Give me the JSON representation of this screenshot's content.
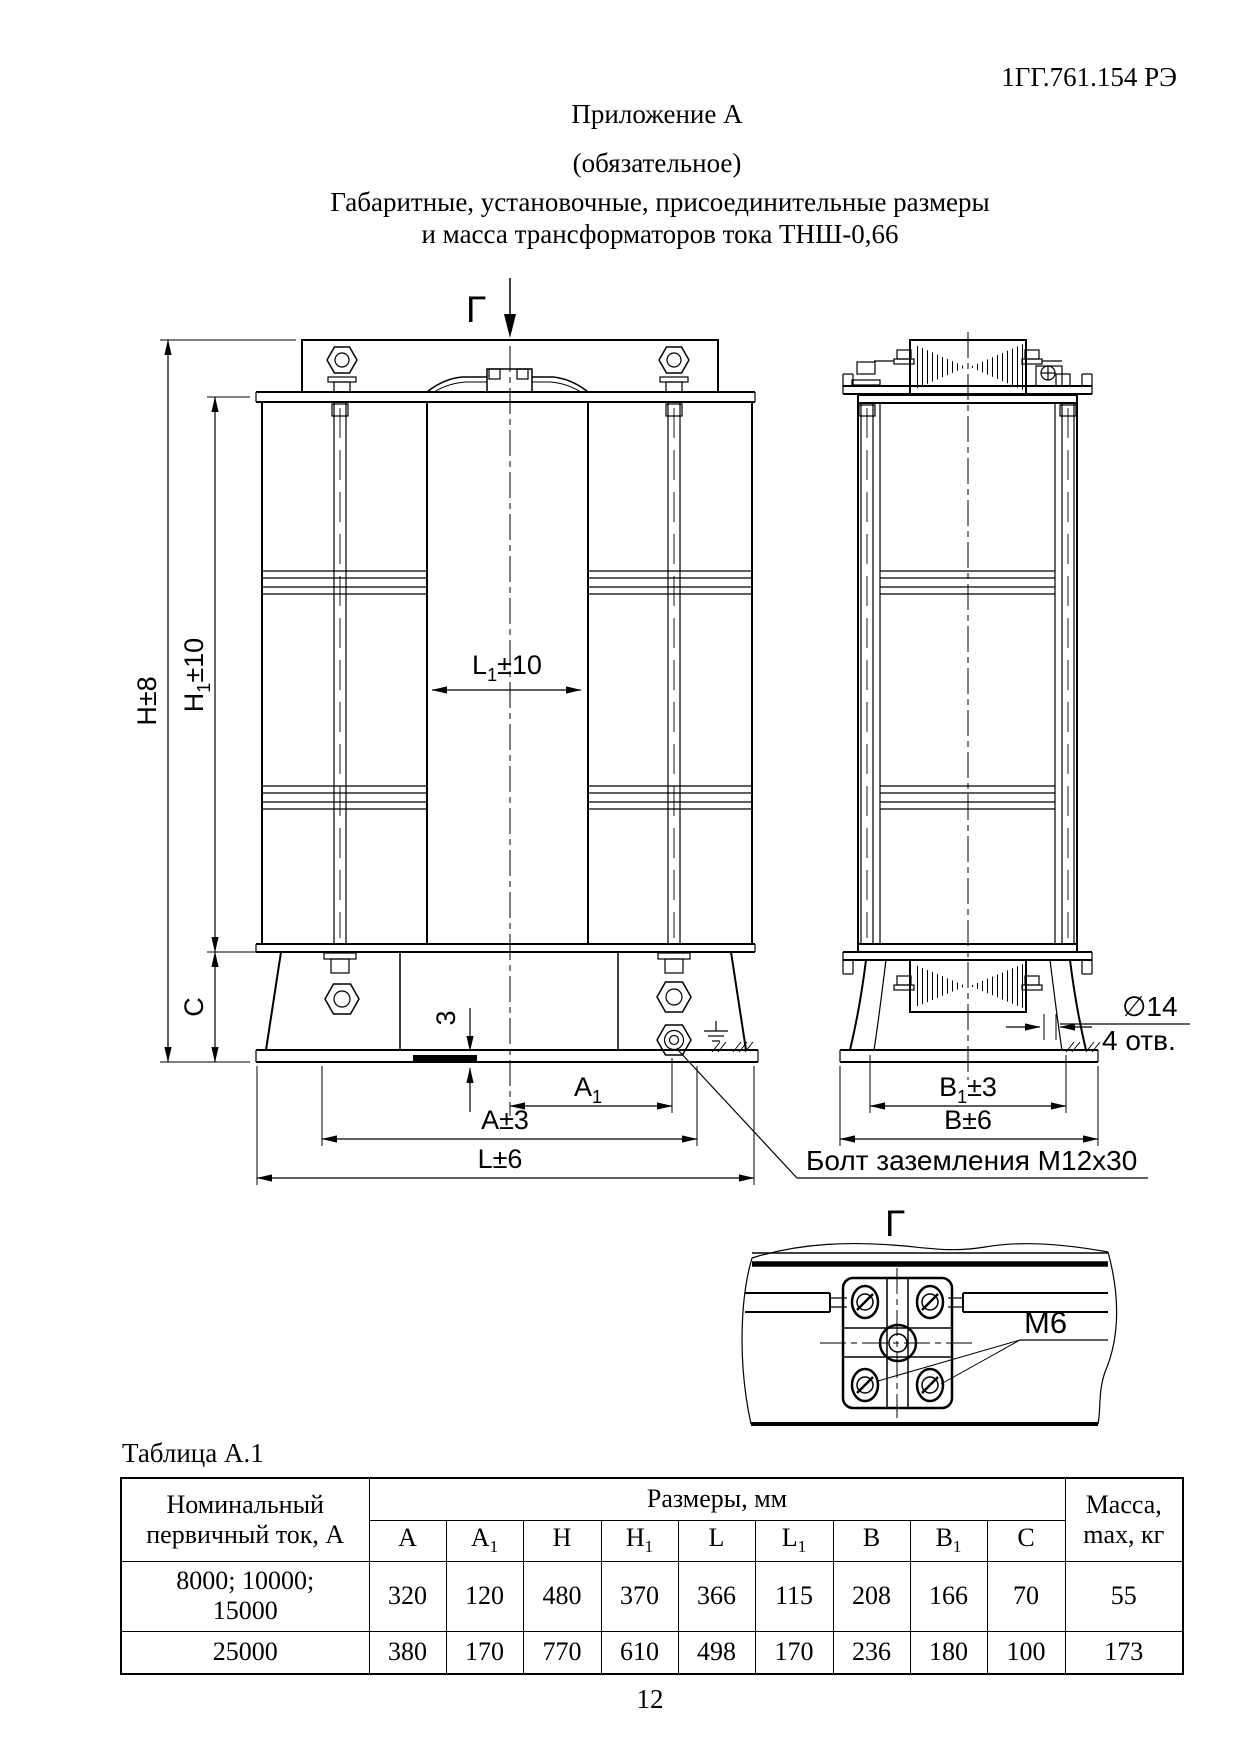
{
  "page": {
    "code": "1ГГ.761.154 РЭ",
    "appendix": "Приложение А",
    "appendix_note": "(обязательное)",
    "title_line1": "Габаритные, установочные, присоединительные размеры",
    "title_line2": "и масса трансформаторов тока ТНШ-0,66",
    "page_number": "12"
  },
  "drawing": {
    "section_mark": "Г",
    "detail_mark": "Г",
    "labels": {
      "h": "H±8",
      "h1": {
        "pre": "H",
        "sub": "1",
        "post": "±10"
      },
      "c": "C",
      "l1": {
        "pre": "L",
        "sub": "1",
        "post": "±10"
      },
      "gap": "3",
      "a1": {
        "pre": "A",
        "sub": "1",
        "post": ""
      },
      "a": "A±3",
      "l": "L±6",
      "b1": {
        "pre": "B",
        "sub": "1",
        "post": "±3"
      },
      "b": "B±6",
      "hole": "∅14",
      "hole_count": "4 отв.",
      "ground_bolt": "Болт заземления М12х30",
      "thread": "М6"
    }
  },
  "table": {
    "caption": "Таблица А.1",
    "col_current": "Номинальный первичный ток, А",
    "col_sizes": "Размеры, мм",
    "col_mass": "Масса, max, кг",
    "dim_headers": [
      {
        "base": "A",
        "sub": ""
      },
      {
        "base": "A",
        "sub": "1"
      },
      {
        "base": "H",
        "sub": ""
      },
      {
        "base": "H",
        "sub": "1"
      },
      {
        "base": "L",
        "sub": ""
      },
      {
        "base": "L",
        "sub": "1"
      },
      {
        "base": "B",
        "sub": ""
      },
      {
        "base": "B",
        "sub": "1"
      },
      {
        "base": "C",
        "sub": ""
      }
    ],
    "rows": [
      {
        "current_line1": "8000; 10000;",
        "current_line2": "15000",
        "values": [
          "320",
          "120",
          "480",
          "370",
          "366",
          "115",
          "208",
          "166",
          "70"
        ],
        "mass": "55"
      },
      {
        "current_line1": "25000",
        "current_line2": "",
        "values": [
          "380",
          "170",
          "770",
          "610",
          "498",
          "170",
          "236",
          "180",
          "100"
        ],
        "mass": "173"
      }
    ]
  }
}
